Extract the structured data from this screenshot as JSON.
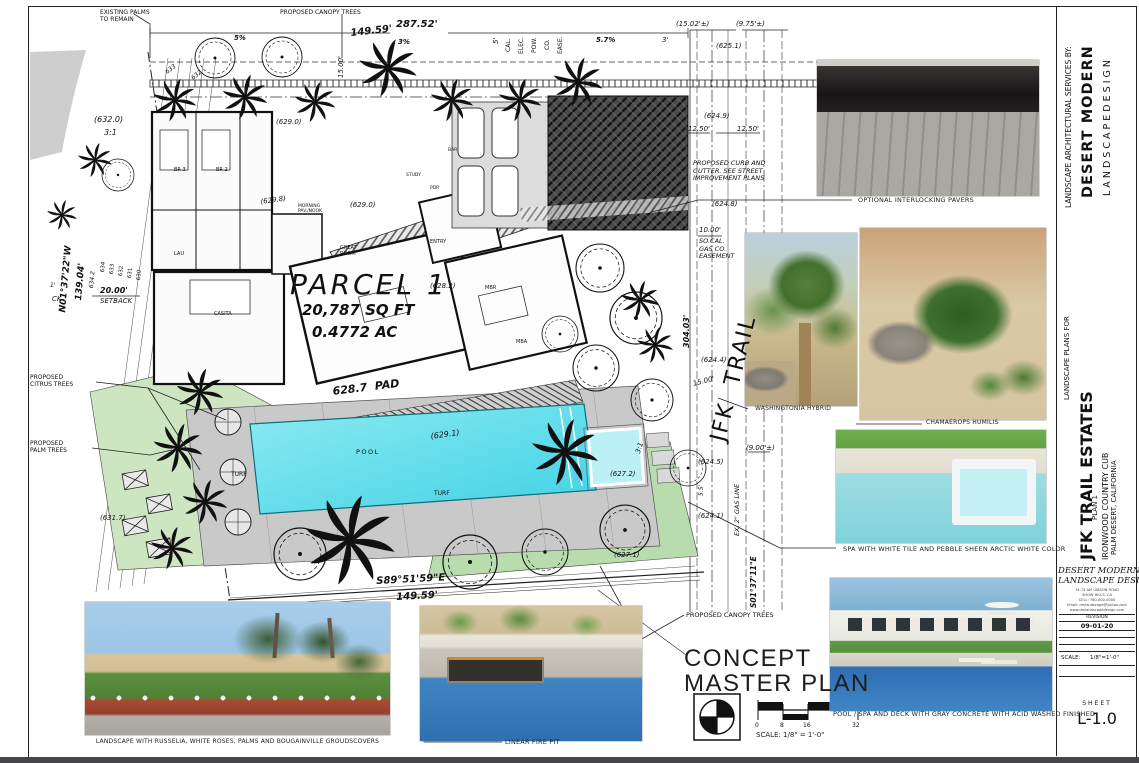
{
  "sheet": {
    "title_line1": "CONCEPT",
    "title_line2": "MASTER PLAN",
    "scale_label": "SCALE: 1/8\" = 1'-0\"",
    "scale_ticks": [
      "0",
      "8",
      "16",
      "32"
    ],
    "sheet_label": "SHEET",
    "sheet_number": "L-1.0"
  },
  "titleblock": {
    "services_by": "LANDSCAPE  ARCHITECTURAL  SERVICES  BY:",
    "firm_name": "DESERT MODERN",
    "firm_subtitle": "L A N D S C A P E   D E S I G N",
    "plans_for": "LANDSCAPE PLANS FOR",
    "project": "JFK TRAIL ESTATES",
    "plan": "PLAN 1",
    "location1": "IRONWOOD COUNTRY CUB",
    "location2": "PALM DESERT, CALIFORNIA",
    "stamp_name1": "DESERT MODERN",
    "stamp_name2": "LANDSCAPE DESIGN",
    "address_lines": [
      "74-75 AM GIBSON ROAD",
      "SHOW HILLS, CA",
      "CELL: 760-000-0000",
      "Email: dmlandscape@yahoo.com",
      "www.dmlandscapedesign.com"
    ],
    "revision_label": "REVISION",
    "revision_date": "09-01-20",
    "scale_row_label": "SCALE:",
    "scale_row_value": "1/8\"=1'-0\""
  },
  "photos": {
    "pavers": {
      "caption": "OPTIONAL INTERLOCKING PAVERS"
    },
    "washingtonia": {
      "caption": "WASHINGTONIA HYBRID"
    },
    "chamaerops": {
      "caption": "CHAMAEROPS HUMILIS"
    },
    "spa": {
      "caption": "SPA WITH WHITE TILE AND PEBBLE SHEEN ARCTIC WHITE COLOR"
    },
    "pool": {
      "caption": "POOL / SPA AND DECK WITH GRAY CONCRETE WITH ACID WASHED FINISHED"
    },
    "landscape": {
      "caption": "LANDSCAPE WITH RUSSELIA, WHITE ROSES, PALMS AND BOUGAINVILLE GROUDSCOVERS"
    },
    "firepit": {
      "caption": "LINEAR FIRE PIT"
    }
  },
  "plan": {
    "colors": {
      "pool": "#3fd2e4",
      "spa": "#b9f1f6",
      "turf": "#cde5c0",
      "deck": "#c9c9c9"
    },
    "parcel": {
      "name": "PARCEL 1",
      "area_sqft": "20,787 SQ FT",
      "area_ac": "0.4772 AC"
    },
    "annotations": [
      {
        "t": "EXISTING PALMS\nTO REMAIN",
        "x": 100,
        "y": 9,
        "s": 6
      },
      {
        "t": "PROPOSED CANOPY TREES",
        "x": 280,
        "y": 9,
        "s": 6
      },
      {
        "t": "287.52'",
        "x": 396,
        "y": 19,
        "s": 10,
        "b": 1,
        "i": 1
      },
      {
        "t": "149.59'",
        "x": 350,
        "y": 28,
        "s": 10,
        "b": 1,
        "i": 1,
        "r": -6
      },
      {
        "t": "15.00'",
        "x": 337,
        "y": 78,
        "s": 7,
        "i": 1,
        "r": -90
      },
      {
        "t": "5'",
        "x": 492,
        "y": 44,
        "s": 7,
        "i": 1,
        "r": -90
      },
      {
        "t": "CAL.",
        "x": 505,
        "y": 52,
        "s": 6,
        "r": -90
      },
      {
        "t": "ELEC.",
        "x": 518,
        "y": 54,
        "s": 6,
        "r": -90
      },
      {
        "t": "POW.",
        "x": 531,
        "y": 53,
        "s": 6,
        "r": -90
      },
      {
        "t": "CO.",
        "x": 544,
        "y": 50,
        "s": 6,
        "r": -90
      },
      {
        "t": "EASE.",
        "x": 557,
        "y": 54,
        "s": 6,
        "r": -90
      },
      {
        "t": "3%",
        "x": 398,
        "y": 38,
        "s": 7,
        "b": 1,
        "i": 1
      },
      {
        "t": "5%",
        "x": 234,
        "y": 34,
        "s": 7,
        "b": 1,
        "i": 1
      },
      {
        "t": "5.7%",
        "x": 596,
        "y": 36,
        "s": 7,
        "b": 1,
        "i": 1
      },
      {
        "t": "3'",
        "x": 662,
        "y": 36,
        "s": 7,
        "i": 1
      },
      {
        "t": "(15.02'±)",
        "x": 676,
        "y": 20,
        "s": 7,
        "i": 1
      },
      {
        "t": "(9.75'±)",
        "x": 736,
        "y": 20,
        "s": 7,
        "i": 1
      },
      {
        "t": "(625.1)",
        "x": 716,
        "y": 42,
        "s": 7,
        "i": 1
      },
      {
        "t": "(624.9)",
        "x": 704,
        "y": 112,
        "s": 7,
        "i": 1
      },
      {
        "t": "12.50'",
        "x": 688,
        "y": 125,
        "s": 7,
        "i": 1
      },
      {
        "t": "12.50'",
        "x": 737,
        "y": 125,
        "s": 7,
        "i": 1
      },
      {
        "t": "PROPOSED CURB AND\nGUTTER. SEE STREET\nIMPROVEMENT PLANS",
        "x": 693,
        "y": 160,
        "s": 6.5,
        "i": 1
      },
      {
        "t": "(624.8)",
        "x": 712,
        "y": 200,
        "s": 7,
        "i": 1
      },
      {
        "t": "10.00'",
        "x": 699,
        "y": 226,
        "s": 7,
        "i": 1
      },
      {
        "t": "SO.CAL.\nGAS CO.\nEASEMENT",
        "x": 699,
        "y": 238,
        "s": 6.5,
        "i": 1
      },
      {
        "t": "304.03'",
        "x": 682,
        "y": 348,
        "s": 8,
        "b": 1,
        "i": 1,
        "r": -90
      },
      {
        "t": "JFK  TRAIL",
        "x": 706,
        "y": 438,
        "s": 22,
        "r": -76,
        "ls": 2
      },
      {
        "t": "(624.4)",
        "x": 701,
        "y": 356,
        "s": 7,
        "i": 1
      },
      {
        "t": "15.00'",
        "x": 692,
        "y": 380,
        "s": 7,
        "i": 1,
        "r": -14
      },
      {
        "t": "(9.00'±)",
        "x": 746,
        "y": 444,
        "s": 7,
        "i": 1
      },
      {
        "t": "(624.5)",
        "x": 698,
        "y": 458,
        "s": 7,
        "i": 1
      },
      {
        "t": "5.5'",
        "x": 698,
        "y": 496,
        "s": 6,
        "i": 1,
        "r": -90
      },
      {
        "t": "EX. 2\" GAS LINE",
        "x": 734,
        "y": 536,
        "s": 6.5,
        "i": 1,
        "r": -90
      },
      {
        "t": "(624.1)",
        "x": 698,
        "y": 512,
        "s": 7,
        "i": 1
      },
      {
        "t": "S01°37'11\"E",
        "x": 750,
        "y": 608,
        "s": 7.5,
        "b": 1,
        "i": 1,
        "r": -90
      },
      {
        "t": "(627.2)",
        "x": 610,
        "y": 470,
        "s": 7,
        "i": 1
      },
      {
        "t": "(627.1)",
        "x": 614,
        "y": 551,
        "s": 7,
        "i": 1
      },
      {
        "t": "3:1",
        "x": 634,
        "y": 452,
        "s": 7,
        "i": 1,
        "r": -72
      },
      {
        "t": "(632.0)",
        "x": 94,
        "y": 115,
        "s": 8,
        "i": 1
      },
      {
        "t": "3:1",
        "x": 104,
        "y": 128,
        "s": 8,
        "i": 1
      },
      {
        "t": "N01°37'22\"W",
        "x": 58,
        "y": 312,
        "s": 9,
        "b": 1,
        "i": 1,
        "r": -85
      },
      {
        "t": "139.04'",
        "x": 74,
        "y": 300,
        "s": 9,
        "b": 1,
        "i": 1,
        "r": -85
      },
      {
        "t": "634.2",
        "x": 88,
        "y": 288,
        "s": 6,
        "i": 1,
        "r": -85
      },
      {
        "t": "634",
        "x": 100,
        "y": 272,
        "s": 5.5,
        "r": -85
      },
      {
        "t": "633",
        "x": 109,
        "y": 274,
        "s": 5.5,
        "r": -85
      },
      {
        "t": "632",
        "x": 118,
        "y": 276,
        "s": 5.5,
        "r": -85
      },
      {
        "t": "631",
        "x": 127,
        "y": 278,
        "s": 5.5,
        "r": -85
      },
      {
        "t": "630",
        "x": 136,
        "y": 280,
        "s": 5.5,
        "r": -85
      },
      {
        "t": "20.00'",
        "x": 100,
        "y": 286,
        "s": 8,
        "b": 1,
        "i": 1
      },
      {
        "t": "SETBACK",
        "x": 100,
        "y": 297,
        "s": 7,
        "i": 1
      },
      {
        "t": "CK",
        "x": 52,
        "y": 295,
        "s": 7,
        "i": 1
      },
      {
        "t": "1'",
        "x": 50,
        "y": 282,
        "s": 6,
        "i": 1
      },
      {
        "t": "PROPOSED\nCITRUS TREES",
        "x": 30,
        "y": 374,
        "s": 6
      },
      {
        "t": "PROPOSED\nPALM TREES",
        "x": 30,
        "y": 440,
        "s": 6
      },
      {
        "t": "(631.7)",
        "x": 100,
        "y": 514,
        "s": 7,
        "i": 1
      },
      {
        "t": "PARCEL 1",
        "x": 290,
        "y": 268,
        "s": 28,
        "i": 1,
        "ls": 3
      },
      {
        "t": "20,787 SQ FT",
        "x": 302,
        "y": 302,
        "s": 15,
        "b": 1,
        "i": 1
      },
      {
        "t": "0.4772 AC",
        "x": 312,
        "y": 324,
        "s": 15,
        "b": 1,
        "i": 1
      },
      {
        "t": "628.7  PAD",
        "x": 332,
        "y": 386,
        "s": 11,
        "b": 1,
        "i": 1,
        "r": -7
      },
      {
        "t": "POOL",
        "x": 356,
        "y": 449,
        "s": 6.5,
        "ls": 1.5
      },
      {
        "t": "TURF",
        "x": 231,
        "y": 471,
        "s": 6
      },
      {
        "t": "TURF",
        "x": 434,
        "y": 490,
        "s": 6
      },
      {
        "t": "(629.1)",
        "x": 430,
        "y": 432,
        "s": 8,
        "i": 1,
        "r": -8
      },
      {
        "t": "(629.0)",
        "x": 276,
        "y": 118,
        "s": 7,
        "i": 1
      },
      {
        "t": "(629.8)",
        "x": 260,
        "y": 198,
        "s": 7,
        "i": 1,
        "r": -8
      },
      {
        "t": "(629.0)",
        "x": 350,
        "y": 201,
        "s": 7,
        "i": 1
      },
      {
        "t": "(628.2)",
        "x": 430,
        "y": 282,
        "s": 7,
        "i": 1
      },
      {
        "t": "BR 3",
        "x": 174,
        "y": 168,
        "s": 5
      },
      {
        "t": "BR 2",
        "x": 216,
        "y": 168,
        "s": 5
      },
      {
        "t": "LAU",
        "x": 174,
        "y": 252,
        "s": 5
      },
      {
        "t": "CASITA",
        "x": 214,
        "y": 312,
        "s": 5
      },
      {
        "t": "GREAT\nROOM",
        "x": 340,
        "y": 246,
        "s": 5
      },
      {
        "t": "ENTRY",
        "x": 430,
        "y": 240,
        "s": 5
      },
      {
        "t": "MBR",
        "x": 485,
        "y": 286,
        "s": 5
      },
      {
        "t": "MBA",
        "x": 516,
        "y": 340,
        "s": 5
      },
      {
        "t": "PDR",
        "x": 430,
        "y": 186,
        "s": 4.5
      },
      {
        "t": "BAR",
        "x": 448,
        "y": 148,
        "s": 4.5
      },
      {
        "t": "STUDY",
        "x": 406,
        "y": 173,
        "s": 4.5
      },
      {
        "t": "MORNING\nPAV./NOOK",
        "x": 298,
        "y": 204,
        "s": 4.5
      },
      {
        "t": "S89°51'59\"E",
        "x": 376,
        "y": 576,
        "s": 10,
        "b": 1,
        "i": 1,
        "r": -3
      },
      {
        "t": "149.59'",
        "x": 396,
        "y": 592,
        "s": 10,
        "b": 1,
        "i": 1,
        "r": -3
      },
      {
        "t": "PROPOSED CANOPY TREES",
        "x": 686,
        "y": 612,
        "s": 6.5
      },
      {
        "t": "633",
        "x": 164,
        "y": 70,
        "s": 6,
        "i": 1,
        "r": -38
      },
      {
        "t": "632",
        "x": 190,
        "y": 76,
        "s": 6,
        "i": 1,
        "r": -38
      }
    ]
  }
}
